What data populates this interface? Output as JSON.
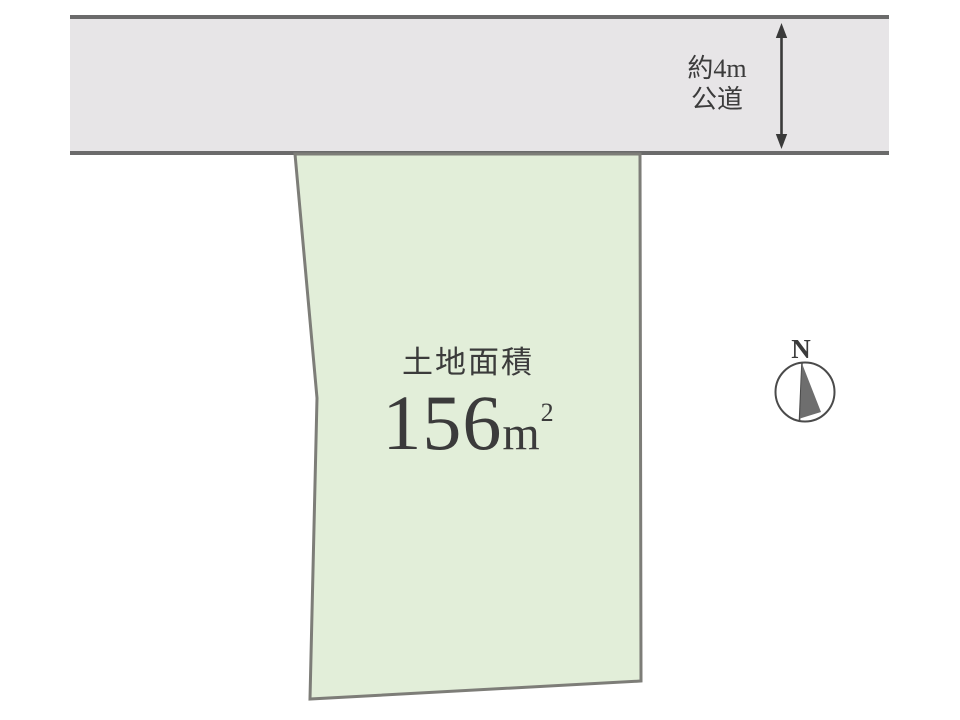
{
  "road": {
    "width_label": "約4m",
    "type_label": "公道"
  },
  "plot": {
    "area_caption": "土地面積",
    "area_value": "156",
    "area_unit_base": "m",
    "area_unit_exponent": "2"
  },
  "compass": {
    "north_label": "N"
  },
  "colors": {
    "background": "#ffffff",
    "road_fill": "#e7e5e7",
    "road_border": "#6b6b6b",
    "plot_fill": "#e2eed9",
    "plot_border": "#7d7d78",
    "text": "#3b3b3b",
    "arrow": "#3a3a3a",
    "compass_stroke": "#4a4a4a",
    "compass_needle_fill": "#6e6e6e"
  }
}
